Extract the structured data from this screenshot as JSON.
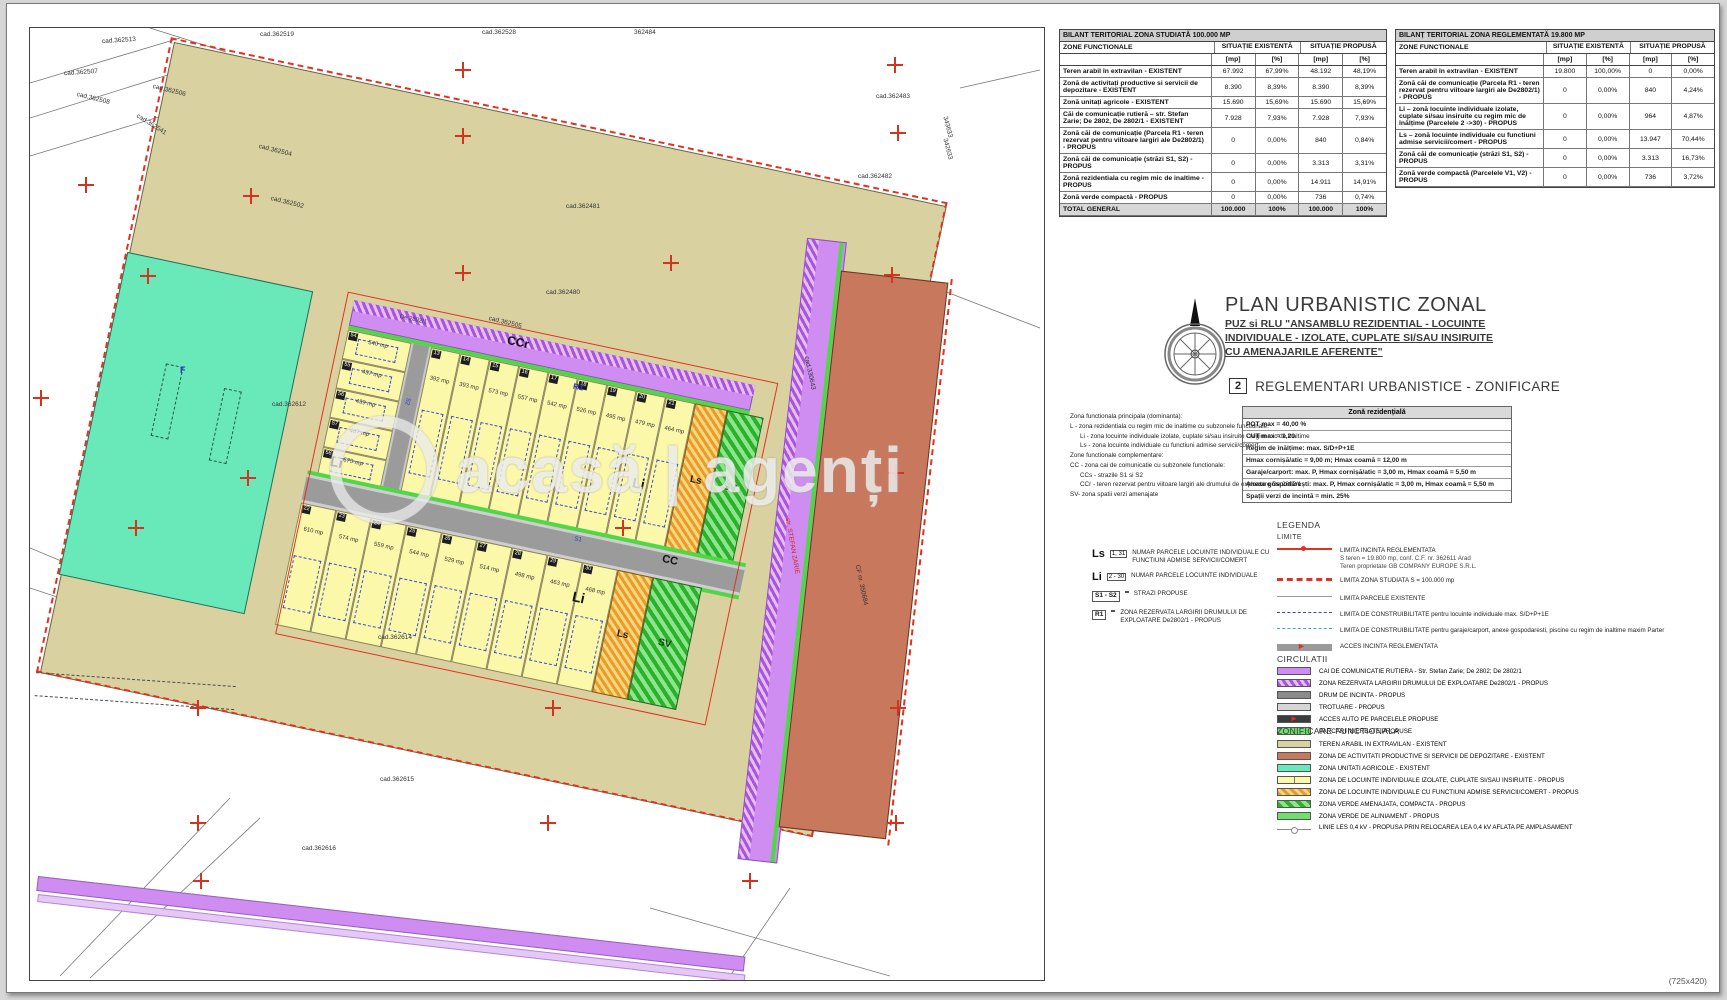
{
  "page": {
    "watermark": "acasă | agenți",
    "paper_size": "(725x420)"
  },
  "tables": {
    "col_func": "ZONE FUNCTIONALE",
    "col_exist": "SITUAȚIE EXISTENTĂ",
    "col_prop": "SITUAȚIE PROPUSĂ",
    "unit_mp": "[mp]",
    "unit_pct": "[%]",
    "studied": {
      "title": "BILANT TERITORIAL ZONA STUDIATĂ 100.000 MP",
      "rows": [
        {
          "label": "Teren arabil în extravilan - EXISTENT",
          "e_mp": "67.992",
          "e_pct": "67,99%",
          "p_mp": "48.192",
          "p_pct": "48,19%"
        },
        {
          "label": "Zonă de activitați productive si servicii de depozitare - EXISTENT",
          "e_mp": "8.390",
          "e_pct": "8,39%",
          "p_mp": "8.390",
          "p_pct": "8,39%"
        },
        {
          "label": "Zonă unitați agricole - EXISTENT",
          "e_mp": "15.690",
          "e_pct": "15,69%",
          "p_mp": "15.690",
          "p_pct": "15,69%"
        },
        {
          "label": "Căi de comunicație rutieră – str. Stefan Zarie; De 2802, De 2802/1 - EXISTENT",
          "e_mp": "7.928",
          "e_pct": "7,93%",
          "p_mp": "7.928",
          "p_pct": "7,93%"
        },
        {
          "label": "Zonă căi de comunicație (Parcela R1 - teren rezervat pentru viitoare largiri ale De2802/1) - PROPUS",
          "e_mp": "0",
          "e_pct": "0,00%",
          "p_mp": "840",
          "p_pct": "0,84%"
        },
        {
          "label": "Zonă căi de comunicație (străzi S1, S2) - PROPUS",
          "e_mp": "0",
          "e_pct": "0,00%",
          "p_mp": "3.313",
          "p_pct": "3,31%"
        },
        {
          "label": "Zonă rezidentiala cu regim mic de inaltime - PROPUS",
          "e_mp": "0",
          "e_pct": "0,00%",
          "p_mp": "14.911",
          "p_pct": "14,91%"
        },
        {
          "label": "Zonă verde compactă - PROPUS",
          "e_mp": "0",
          "e_pct": "0,00%",
          "p_mp": "736",
          "p_pct": "0,74%"
        },
        {
          "label": "TOTAL GENERAL",
          "e_mp": "100.000",
          "e_pct": "100%",
          "p_mp": "100.000",
          "p_pct": "100%",
          "cls": "total"
        }
      ]
    },
    "regulated": {
      "title": "BILANȚ TERITORIAL ZONA REGLEMENTATĂ 19.800 MP",
      "rows": [
        {
          "label": "Teren arabil în extravilan - EXISTENT",
          "e_mp": "19.800",
          "e_pct": "100,00%",
          "p_mp": "0",
          "p_pct": "0,00%"
        },
        {
          "label": "Zonă căi de comunicație (Parcela R1 - teren rezervat pentru viitoare largiri ale De2802/1) - PROPUS",
          "e_mp": "0",
          "e_pct": "0,00%",
          "p_mp": "840",
          "p_pct": "4,24%"
        },
        {
          "label": "Li – zonă locuinte individuale izolate, cuplate si/sau insiruite cu regim mic de înălțime (Parcelele 2 ->30) - PROPUS",
          "e_mp": "0",
          "e_pct": "0,00%",
          "p_mp": "964",
          "p_pct": "4,87%"
        },
        {
          "label": "Ls – zonă locuinte individuale cu functiuni admise servicii/comert - PROPUS",
          "e_mp": "0",
          "e_pct": "0,00%",
          "p_mp": "13.947",
          "p_pct": "70,44%"
        },
        {
          "label": "Zonă căi de comunicație (străzi S1, S2) - PROPUS",
          "e_mp": "0",
          "e_pct": "0,00%",
          "p_mp": "3.313",
          "p_pct": "16,73%"
        },
        {
          "label": "Zonă verde compactă (Parcelele V1, V2) - PROPUS",
          "e_mp": "0",
          "e_pct": "0,00%",
          "p_mp": "736",
          "p_pct": "3,72%"
        }
      ]
    }
  },
  "titleblock": {
    "title": "PLAN URBANISTIC ZONAL",
    "sub_lines": [
      {
        "t": "PUZ si RLU \"ANSAMBLU REZIDENTIAL - LOCUINTE"
      },
      {
        "t": "INDIVIDUALE - IZOLATE, CUPLATE SI/SAU INSIRUITE"
      },
      {
        "t": "CU AMENAJARILE AFERENTE\""
      }
    ],
    "plansa_no": "2",
    "plansa_title": "REGLEMENTARI URBANISTICE - ZONIFICARE"
  },
  "functext": {
    "lines": [
      {
        "t": "Zona functionala principala (dominanta):",
        "ind": 0
      },
      {
        "t": "L - zona rezidentiala cu regim mic de inaltime cu subzonele functionale:",
        "ind": 0
      },
      {
        "t": "Li - zona locuinte individuale izolate, cuplate si/sau insiruite - regim mic de inaltime",
        "ind": 10
      },
      {
        "t": "Ls - zona locuinte individuale cu functiuni admise servicii/comert",
        "ind": 10
      },
      {
        "t": "Zone functionale complementare:",
        "ind": 0
      },
      {
        "t": "CC - zona cai de comunicatie cu subzonele functionale:",
        "ind": 0
      },
      {
        "t": "CCs - strazile S1 si S2",
        "ind": 10
      },
      {
        "t": "CCr - teren rezervat pentru viitoare largiri ale drumului de exploatare De 2802/1",
        "ind": 10
      },
      {
        "t": "SV- zona spatii verzi amenajate",
        "ind": 0
      }
    ]
  },
  "regulations": {
    "header": "Zonă rezidențială",
    "rows": [
      {
        "t": "POT max = 40,00 %"
      },
      {
        "t": "CUT max = 1,20"
      },
      {
        "t": "Regim de înălțime: max. S/D+P+1E"
      },
      {
        "t": "Hmax cornișă/atic = 9,00 m; Hmax coamă = 12,00 m"
      },
      {
        "t": "Garaje/carport: max. P, Hmax cornișă/atic = 3,00 m, Hmax coamă = 5,50 m"
      },
      {
        "t": "Anexe gospodărești: max. P, Hmax cornișă/atic = 3,00 m, Hmax coamă = 5,50 m"
      },
      {
        "t": "Spații verzi de incintă = min. 25%"
      }
    ]
  },
  "legend": {
    "title": "LEGENDA",
    "limits_title": "LIMITE",
    "circulatii_title": "CIRCULATII",
    "zonificare_title": "ZONIFICARE FUNCTIONALA",
    "num_items": [
      {
        "tag": "Ls",
        "sup": "1, 31",
        "label": "NUMAR PARCELE LOCUINTE INDIVIDUALE CU FUNCTIUNI ADMISE SERVICII/COMERT",
        "big": 1
      },
      {
        "tag": "Li",
        "sup": "2 - 30",
        "label": "NUMAR PARCELE LOCUINTE INDIVIDUALE",
        "big": 1
      },
      {
        "tag": "S1 - S2",
        "sup": "",
        "label": "STRAZI PROPUSE"
      },
      {
        "tag": "R1",
        "sup": "",
        "label": "ZONA REZERVATA LARGIRII DRUMULUI DE EXPLOATARE De2802/1 - PROPUS"
      }
    ],
    "limits": [
      {
        "cls": "lim-inc",
        "label": "LIMITA INCINTA REGLEMENTATA",
        "n1": "S teren = 19.800 mp, conf. C.F. nr. 362611 Arad",
        "n2": "Teren proprietate GB COMPANY EUROPE S.R.L."
      },
      {
        "cls": "lim-stud",
        "label": "LIMITA ZONA STUDIATA  S = 100.000 mp",
        "n1": "",
        "n2": ""
      },
      {
        "cls": "lim-parc",
        "label": "LIMITA PARCELE EXISTENTE",
        "n1": "",
        "n2": ""
      },
      {
        "cls": "lim-blue",
        "label": "LIMITA DE CONSTRUIBILITATE pentru locuinte individuale max. S/D+P+1E",
        "n1": "",
        "n2": ""
      },
      {
        "cls": "lim-cyan",
        "label": "LIMITA DE CONSTRUIBILITATE pentru garaje/carport, anexe gospodaresti, piscine cu regim de inaltime maxim Parter",
        "n1": "",
        "n2": ""
      },
      {
        "cls": "lim-acc",
        "label": "ACCES INCINTA REGLEMENTATA",
        "n1": "",
        "n2": ""
      }
    ],
    "circulatii": [
      {
        "cls": "sw-purple",
        "label": "CAI DE COMUNICATIE RUTIERA - Str. Stefan Zarie; De 2802; De 2802/1"
      },
      {
        "cls": "sw-purpleh",
        "label": "ZONA REZERVATA LARGIRII DRUMULUI DE EXPLOATARE De2802/1 - PROPUS"
      },
      {
        "cls": "sw-dgray",
        "label": "DRUM DE INCINTA - PROPUS"
      },
      {
        "cls": "sw-lgray",
        "label": "TROTUARE - PROPUS"
      },
      {
        "cls": "sw-access",
        "label": "ACCES AUTO PE PARCELELE PROPUSE"
      },
      {
        "cls": "sw-pgreen",
        "label": "PARCARI INIERBATE PROPUSE"
      }
    ],
    "zonificare": [
      {
        "cls": "sw-tan",
        "label": "TEREN ARABIL IN EXTRAVILAN - EXISTENT"
      },
      {
        "cls": "sw-salmon",
        "label": "ZONA DE ACTIVITATI PRODUCTIVE SI SERVICII DE DEPOZITARE - EXISTENT"
      },
      {
        "cls": "sw-teal",
        "label": "ZONA UNITATI AGRICOLE - EXISTENT"
      },
      {
        "cls": "sw-yellow2",
        "label": "ZONA DE LOCUINTE INDIVIDUALE IZOLATE, CUPLATE SI/SAU INSIRUITE - PROPUS"
      },
      {
        "cls": "sw-orangeh",
        "label": "ZONA DE LOCUINTE INDIVIDUALE CU FUNCTIUNI ADMISE SERVICII/COMERT - PROPUS"
      },
      {
        "cls": "sw-greenh",
        "label": "ZONA VERDE AMENAJATA, COMPACTA - PROPUS"
      },
      {
        "cls": "sw-pgreen",
        "label": "ZONA VERDE DE ALINIAMENT - PROPUS"
      },
      {
        "cls": "sw-lesline",
        "label": "LINIE LES 0,4 kV - PROPUSA PRIN RELOCAREA LEA 0,4 kV AFLATA PE AMPLASAMENT"
      }
    ]
  },
  "map": {
    "mp_unit": "mp",
    "ls_label": "Ls",
    "sv_label": "SV",
    "col_left": [
      {
        "n": "54",
        "mp": "540"
      },
      {
        "n": "55",
        "mp": "437"
      },
      {
        "n": "56",
        "mp": "439"
      },
      {
        "n": "57",
        "mp": "467"
      },
      {
        "n": "58",
        "mp": "675"
      }
    ],
    "row_upper": [
      {
        "n": "13",
        "mp": "392"
      },
      {
        "n": "14",
        "mp": "393"
      },
      {
        "n": "15",
        "mp": "573"
      },
      {
        "n": "16",
        "mp": "557"
      },
      {
        "n": "17",
        "mp": "542"
      },
      {
        "n": "18",
        "mp": "526"
      },
      {
        "n": "19",
        "mp": "495"
      },
      {
        "n": "20",
        "mp": "479"
      },
      {
        "n": "21",
        "mp": "464"
      }
    ],
    "row_lower": [
      {
        "n": "22",
        "mp": "610"
      },
      {
        "n": "23",
        "mp": "574"
      },
      {
        "n": "24",
        "mp": "559"
      },
      {
        "n": "25",
        "mp": "544"
      },
      {
        "n": "26",
        "mp": "529"
      },
      {
        "n": "27",
        "mp": "514"
      },
      {
        "n": "28",
        "mp": "498"
      },
      {
        "n": "29",
        "mp": "463"
      },
      {
        "n": "30",
        "mp": "468"
      }
    ],
    "tilt_labels": [
      {
        "t": "De 2802/1",
        "x": 278,
        "y": 219,
        "s": 6,
        "c": "#403060"
      },
      {
        "t": "CCr",
        "x": 388,
        "y": 216,
        "s": 12,
        "b": 1
      },
      {
        "t": "R1",
        "x": 462,
        "y": 250,
        "s": 8,
        "b": 1,
        "c": "#2a35c8"
      },
      {
        "t": "Li",
        "x": 240,
        "y": 370,
        "s": 14,
        "b": 1
      },
      {
        "t": "Li",
        "x": 540,
        "y": 328,
        "s": 14,
        "b": 1
      },
      {
        "t": "Li",
        "x": 505,
        "y": 452,
        "s": 14,
        "b": 1
      },
      {
        "t": "CC",
        "x": 585,
        "y": 399,
        "s": 11,
        "b": 1
      },
      {
        "t": "S1",
        "x": 495,
        "y": 400,
        "s": 6,
        "c": "#2a35c8"
      },
      {
        "t": "S2",
        "x": 299,
        "y": 300,
        "s": 6,
        "c": "#2a35c8",
        "r": 90
      }
    ],
    "labels": [
      {
        "t": "cad.362513",
        "x": 72,
        "y": 10,
        "r": -4
      },
      {
        "t": "cad.362507",
        "x": 34,
        "y": 42,
        "r": -4
      },
      {
        "t": "cad.362508",
        "x": 46,
        "y": 68,
        "r": 14
      },
      {
        "t": "cad.362506",
        "x": 122,
        "y": 60,
        "r": 14
      },
      {
        "t": "cad.362541",
        "x": 104,
        "y": 94,
        "r": 32
      },
      {
        "t": "cad.362504",
        "x": 228,
        "y": 120,
        "r": 14
      },
      {
        "t": "cad.362502",
        "x": 240,
        "y": 172,
        "r": 14
      },
      {
        "t": "cad.362519",
        "x": 230,
        "y": 4
      },
      {
        "t": "cad.362528",
        "x": 452,
        "y": 2
      },
      {
        "t": "362484",
        "x": 604,
        "y": 2
      },
      {
        "t": "cad.362483",
        "x": 846,
        "y": 66
      },
      {
        "t": "343633",
        "x": 906,
        "y": 96,
        "r": 75
      },
      {
        "t": "342633",
        "x": 906,
        "y": 118,
        "r": 75
      },
      {
        "t": "cad.362482",
        "x": 828,
        "y": 146
      },
      {
        "t": "cad.362481",
        "x": 536,
        "y": 176
      },
      {
        "t": "cad.362480",
        "x": 516,
        "y": 262
      },
      {
        "t": "cad.362505",
        "x": 458,
        "y": 292,
        "r": 14
      },
      {
        "t": "cad.362612",
        "x": 242,
        "y": 374
      },
      {
        "t": "F",
        "x": 150,
        "y": 338,
        "c": "#2a35c8",
        "b": 1,
        "s": 9
      },
      {
        "t": "cad.362614",
        "x": 348,
        "y": 607
      },
      {
        "t": "cad.362615",
        "x": 350,
        "y": 749
      },
      {
        "t": "cad.362616",
        "x": 272,
        "y": 818
      },
      {
        "t": "cad.330643",
        "x": 762,
        "y": 342,
        "r": 78
      },
      {
        "t": "CF nr. 350684",
        "x": 810,
        "y": 554,
        "r": 78
      },
      {
        "t": "str. STEFAN ZARIE",
        "x": 733,
        "y": 515,
        "r": 80,
        "c": "#d02818"
      }
    ],
    "crosses": [
      {
        "x": 48,
        "y": 149
      },
      {
        "x": 213,
        "y": 160
      },
      {
        "x": 425,
        "y": 34
      },
      {
        "x": 857,
        "y": 29
      },
      {
        "x": 425,
        "y": 100
      },
      {
        "x": 860,
        "y": 97
      },
      {
        "x": 110,
        "y": 240
      },
      {
        "x": 425,
        "y": 237
      },
      {
        "x": 633,
        "y": 227
      },
      {
        "x": 854,
        "y": 239
      },
      {
        "x": 3,
        "y": 362
      },
      {
        "x": 210,
        "y": 442
      },
      {
        "x": 858,
        "y": 437
      },
      {
        "x": 98,
        "y": 492
      },
      {
        "x": 585,
        "y": 492
      },
      {
        "x": 160,
        "y": 672
      },
      {
        "x": 515,
        "y": 672
      },
      {
        "x": 860,
        "y": 672
      },
      {
        "x": 160,
        "y": 787
      },
      {
        "x": 510,
        "y": 787
      },
      {
        "x": 858,
        "y": 787
      },
      {
        "x": 163,
        "y": 845
      },
      {
        "x": 712,
        "y": 845
      }
    ]
  }
}
